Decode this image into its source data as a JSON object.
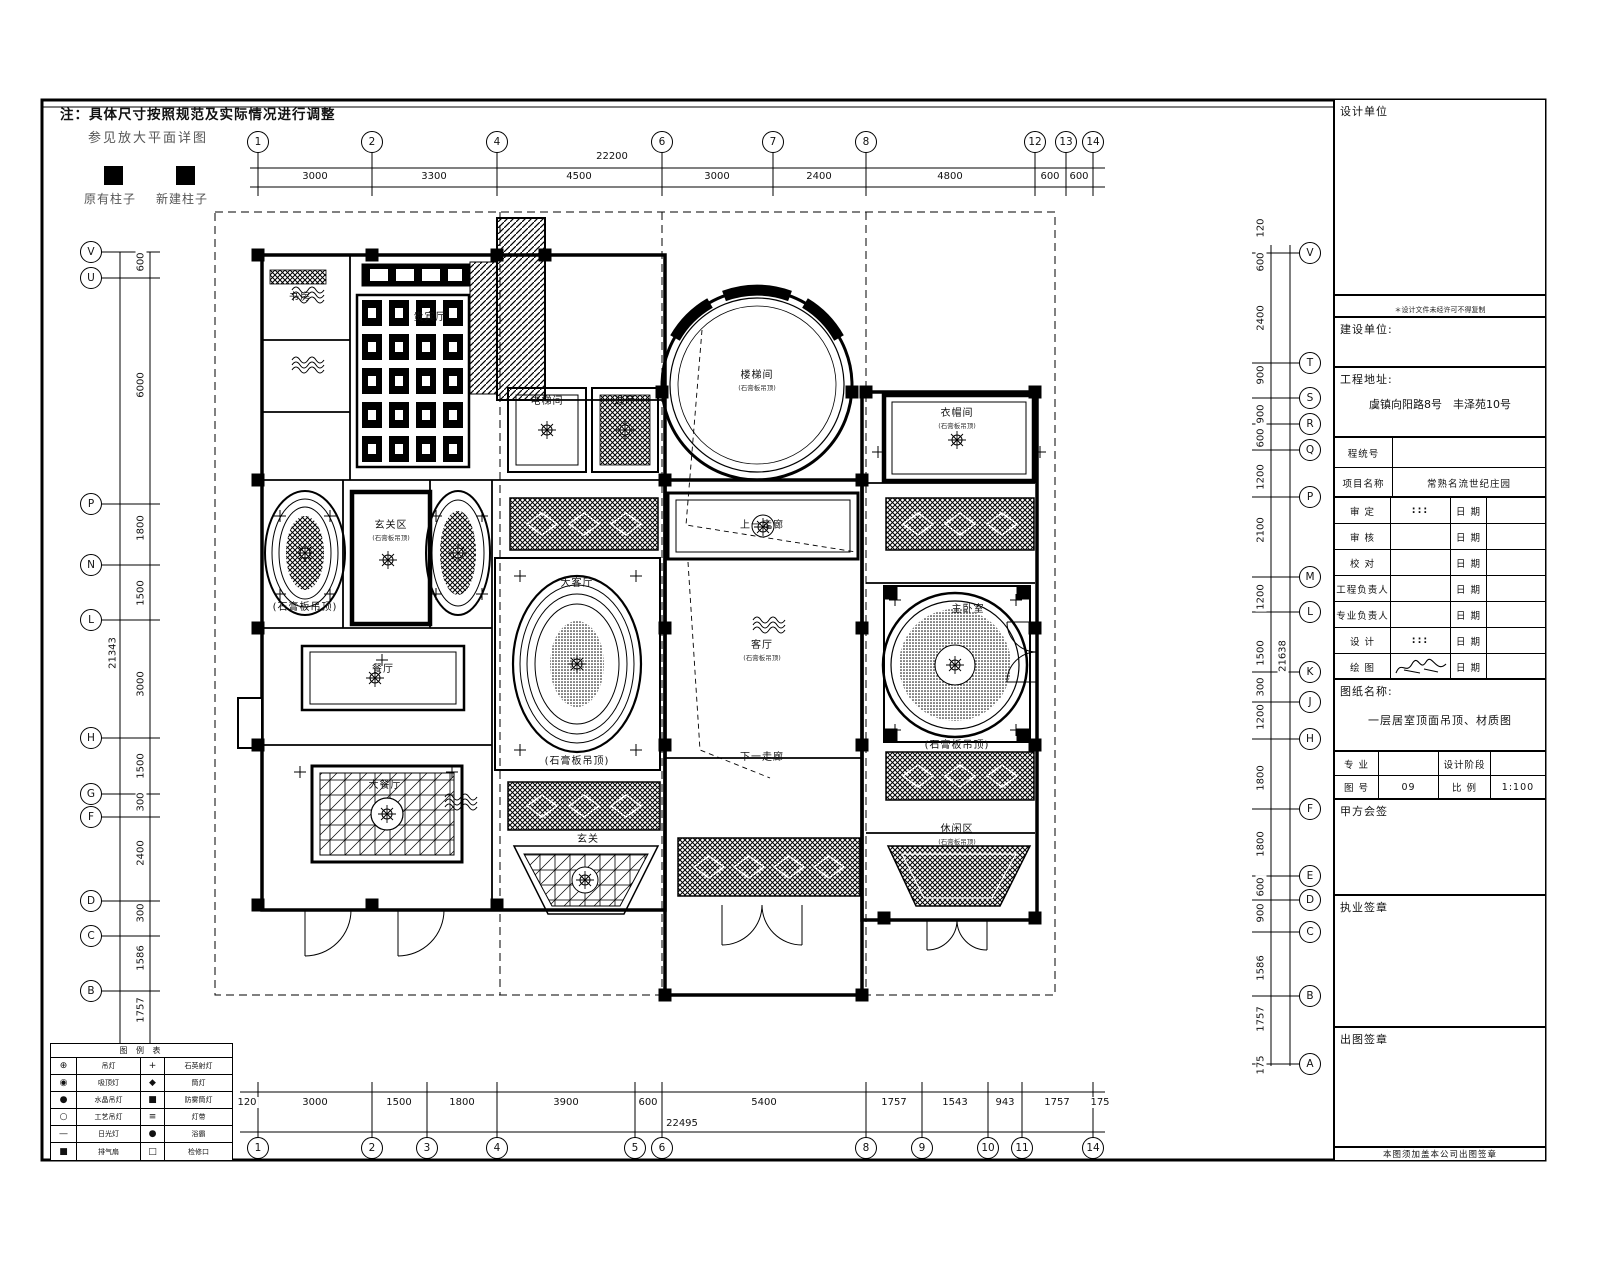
{
  "note": {
    "line1": "注：具体尺寸按照规范及实际情况进行调整",
    "line2": "参见放大平面详图",
    "existing_column": "原有柱子",
    "new_column": "新建柱子"
  },
  "axes": {
    "top": {
      "total": {
        "t": "22200",
        "x": 612,
        "y": 151
      },
      "bubbles": [
        {
          "t": "1",
          "x": 258
        },
        {
          "t": "2",
          "x": 372
        },
        {
          "t": "4",
          "x": 497
        },
        {
          "t": "6",
          "x": 662
        },
        {
          "t": "7",
          "x": 773
        },
        {
          "t": "8",
          "x": 866
        },
        {
          "t": "12",
          "x": 1035
        },
        {
          "t": "13",
          "x": 1066
        },
        {
          "t": "14",
          "x": 1093
        }
      ],
      "dims": [
        {
          "t": "3000",
          "x": 315
        },
        {
          "t": "3300",
          "x": 434
        },
        {
          "t": "4500",
          "x": 579
        },
        {
          "t": "3000",
          "x": 717
        },
        {
          "t": "2400",
          "x": 819
        },
        {
          "t": "4800",
          "x": 950
        },
        {
          "t": "600",
          "x": 1050
        },
        {
          "t": "600",
          "x": 1079
        }
      ]
    },
    "bottom": {
      "total": {
        "t": "22495",
        "x": 682,
        "y": 1118
      },
      "bubbles": [
        {
          "t": "1",
          "x": 258
        },
        {
          "t": "2",
          "x": 372
        },
        {
          "t": "3",
          "x": 427
        },
        {
          "t": "4",
          "x": 497
        },
        {
          "t": "5",
          "x": 635
        },
        {
          "t": "6",
          "x": 662
        },
        {
          "t": "8",
          "x": 866
        },
        {
          "t": "9",
          "x": 922
        },
        {
          "t": "10",
          "x": 988
        },
        {
          "t": "11",
          "x": 1022
        },
        {
          "t": "14",
          "x": 1093
        }
      ],
      "dims": [
        {
          "t": "120",
          "x": 247
        },
        {
          "t": "3000",
          "x": 315
        },
        {
          "t": "1500",
          "x": 399
        },
        {
          "t": "1800",
          "x": 462
        },
        {
          "t": "3900",
          "x": 566
        },
        {
          "t": "600",
          "x": 648
        },
        {
          "t": "5400",
          "x": 764
        },
        {
          "t": "1757",
          "x": 894
        },
        {
          "t": "1543",
          "x": 955
        },
        {
          "t": "943",
          "x": 1005
        },
        {
          "t": "1757",
          "x": 1057
        },
        {
          "t": "175",
          "x": 1100
        }
      ]
    },
    "left": {
      "total": {
        "t": "21343",
        "x": 113,
        "y": 653
      },
      "bubbles": [
        {
          "t": "V",
          "y": 252
        },
        {
          "t": "U",
          "y": 278
        },
        {
          "t": "P",
          "y": 504
        },
        {
          "t": "N",
          "y": 565
        },
        {
          "t": "L",
          "y": 620
        },
        {
          "t": "H",
          "y": 738
        },
        {
          "t": "G",
          "y": 794
        },
        {
          "t": "F",
          "y": 817
        },
        {
          "t": "D",
          "y": 901
        },
        {
          "t": "C",
          "y": 936
        },
        {
          "t": "B",
          "y": 991
        },
        {
          "t": "A",
          "y": 1058
        }
      ],
      "dims": [
        {
          "t": "600",
          "y": 262
        },
        {
          "t": "6000",
          "y": 385
        },
        {
          "t": "1800",
          "y": 528
        },
        {
          "t": "1500",
          "y": 593
        },
        {
          "t": "3000",
          "y": 684
        },
        {
          "t": "1500",
          "y": 766
        },
        {
          "t": "300",
          "y": 802
        },
        {
          "t": "2400",
          "y": 853
        },
        {
          "t": "300",
          "y": 913
        },
        {
          "t": "1586",
          "y": 958
        },
        {
          "t": "1757",
          "y": 1010
        }
      ]
    },
    "right": {
      "total": {
        "t": "21638",
        "x": 1283,
        "y": 656
      },
      "bubbles": [
        {
          "t": "V",
          "y": 253
        },
        {
          "t": "T",
          "y": 363
        },
        {
          "t": "S",
          "y": 398
        },
        {
          "t": "R",
          "y": 424
        },
        {
          "t": "Q",
          "y": 450
        },
        {
          "t": "P",
          "y": 497
        },
        {
          "t": "M",
          "y": 577
        },
        {
          "t": "L",
          "y": 612
        },
        {
          "t": "K",
          "y": 672
        },
        {
          "t": "J",
          "y": 702
        },
        {
          "t": "H",
          "y": 739
        },
        {
          "t": "F",
          "y": 809
        },
        {
          "t": "E",
          "y": 876
        },
        {
          "t": "D",
          "y": 900
        },
        {
          "t": "C",
          "y": 932
        },
        {
          "t": "B",
          "y": 996
        },
        {
          "t": "A",
          "y": 1064
        }
      ],
      "dims": [
        {
          "t": "120",
          "y": 228
        },
        {
          "t": "600",
          "y": 262
        },
        {
          "t": "2400",
          "y": 318
        },
        {
          "t": "900",
          "y": 375
        },
        {
          "t": "900",
          "y": 414
        },
        {
          "t": "600",
          "y": 438
        },
        {
          "t": "1200",
          "y": 477
        },
        {
          "t": "2100",
          "y": 530
        },
        {
          "t": "1200",
          "y": 597
        },
        {
          "t": "1500",
          "y": 653
        },
        {
          "t": "300",
          "y": 687
        },
        {
          "t": "1200",
          "y": 717
        },
        {
          "t": "1800",
          "y": 778
        },
        {
          "t": "1800",
          "y": 844
        },
        {
          "t": "600",
          "y": 887
        },
        {
          "t": "900",
          "y": 913
        },
        {
          "t": "1586",
          "y": 968
        },
        {
          "t": "1757",
          "y": 1019
        },
        {
          "t": "175",
          "y": 1065
        }
      ]
    }
  },
  "rooms": [
    {
      "x": 757,
      "y": 366,
      "label": "楼梯间",
      "sub": "(石膏板吊顶)"
    },
    {
      "x": 957,
      "y": 404,
      "label": "衣帽间",
      "sub": "(石膏板吊顶)"
    },
    {
      "x": 391,
      "y": 516,
      "label": "玄关区",
      "sub": "(石膏板吊顶)"
    },
    {
      "x": 430,
      "y": 308,
      "label": "贵宾厅",
      "sub": ""
    },
    {
      "x": 300,
      "y": 288,
      "label": "书房",
      "sub": ""
    },
    {
      "x": 547,
      "y": 392,
      "label": "电梯间",
      "sub": ""
    },
    {
      "x": 625,
      "y": 392,
      "label": "过厅",
      "sub": ""
    },
    {
      "x": 577,
      "y": 574,
      "label": "大客厅",
      "sub": ""
    },
    {
      "x": 577,
      "y": 752,
      "label": "(石膏板吊顶)",
      "sub": ""
    },
    {
      "x": 762,
      "y": 636,
      "label": "客厅",
      "sub": "(石膏板吊顶)"
    },
    {
      "x": 762,
      "y": 748,
      "label": "下一走廊",
      "sub": ""
    },
    {
      "x": 762,
      "y": 516,
      "label": "上一走廊",
      "sub": ""
    },
    {
      "x": 968,
      "y": 600,
      "label": "主卧室",
      "sub": ""
    },
    {
      "x": 383,
      "y": 660,
      "label": "餐厅",
      "sub": ""
    },
    {
      "x": 385,
      "y": 776,
      "label": "大餐厅",
      "sub": ""
    },
    {
      "x": 957,
      "y": 820,
      "label": "休闲区",
      "sub": "(石膏板吊顶)"
    },
    {
      "x": 588,
      "y": 830,
      "label": "玄关",
      "sub": ""
    },
    {
      "x": 305,
      "y": 598,
      "label": "(石膏板吊顶)",
      "sub": ""
    },
    {
      "x": 957,
      "y": 736,
      "label": "(石膏板吊顶)",
      "sub": ""
    }
  ],
  "legend_table": {
    "title": "图 例 表",
    "rows": [
      {
        "s1": "⊕",
        "l1": "吊灯",
        "s2": "+",
        "l2": "石英射灯"
      },
      {
        "s1": "◉",
        "l1": "吸顶灯",
        "s2": "◆",
        "l2": "筒灯"
      },
      {
        "s1": "●",
        "l1": "水晶吊灯",
        "s2": "■",
        "l2": "防雾筒灯"
      },
      {
        "s1": "○",
        "l1": "工艺吊灯",
        "s2": "≡",
        "l2": "灯带"
      },
      {
        "s1": "—",
        "l1": "日光灯",
        "s2": "●",
        "l2": "浴霸"
      },
      {
        "s1": "■",
        "l1": "排气扇",
        "s2": "□",
        "l2": "检修口"
      }
    ]
  },
  "title_block": {
    "design_unit_label": "设计单位",
    "copyright_note": "＊设计文件未经许可不得复制",
    "construction_unit_label": "建设单位:",
    "address_label": "工程地址:",
    "address_value": "虞镇向阳路8号　丰泽苑10号",
    "info_rows": [
      {
        "label": "程统号",
        "value": ""
      },
      {
        "label": "项目名称",
        "value": "常熟名流世纪庄园"
      }
    ],
    "sign_rows": [
      {
        "label": "审  定",
        "mid": ":::",
        "date_label": "日 期",
        "date_value": ""
      },
      {
        "label": "审  核",
        "mid": "",
        "date_label": "日 期",
        "date_value": ""
      },
      {
        "label": "校  对",
        "mid": "",
        "date_label": "日 期",
        "date_value": ""
      },
      {
        "label": "工程负责人",
        "mid": "",
        "date_label": "日 期",
        "date_value": ""
      },
      {
        "label": "专业负责人",
        "mid": "",
        "date_label": "日 期",
        "date_value": ""
      },
      {
        "label": "设  计",
        "mid": ":::",
        "date_label": "日 期",
        "date_value": ""
      },
      {
        "label": "绘  图",
        "mid": "@sig",
        "date_label": "日 期",
        "date_value": ""
      }
    ],
    "sheet_name_label": "图纸名称:",
    "sheet_name": "一层居室顶面吊顶、材质图",
    "major_label": "专  业",
    "major_value": "",
    "phase_label": "设计阶段",
    "phase_value": "",
    "sheet_no_label": "图  号",
    "sheet_no": "09",
    "scale_label": "比  例",
    "scale": "1:100",
    "client_sign_label": "甲方会签",
    "license_seal_label": "执业签章",
    "issue_seal_label": "出图签章",
    "footer_note": "本图须加盖本公司出图签章"
  }
}
